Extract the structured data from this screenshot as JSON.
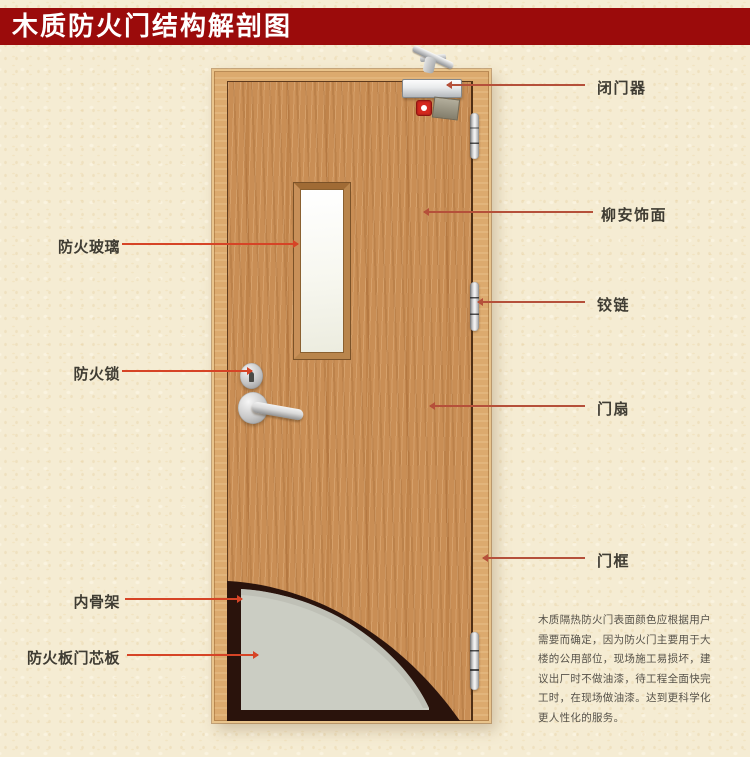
{
  "title": "木质防火门结构解剖图",
  "colors": {
    "banner_bg": "#9b0b0b",
    "banner_text": "#ffffff",
    "background": "#f5ecd3",
    "leader_left": "#d64426",
    "leader_right": "#b5503a",
    "label_text": "#3f3c33",
    "frame_wood": "#dcaa6e",
    "leaf_wood": "#c98e55",
    "skeleton_band": "#2a130c",
    "core_panel": "#cbcdc3",
    "fire_badge": "#d5281e"
  },
  "labels": {
    "left": [
      {
        "id": "fire-glass",
        "text": "防火玻璃"
      },
      {
        "id": "fire-lock",
        "text": "防火锁"
      },
      {
        "id": "inner-skeleton",
        "text": "内骨架"
      },
      {
        "id": "core-board",
        "text": "防火板门芯板"
      }
    ],
    "right": [
      {
        "id": "door-closer",
        "text": "闭门器"
      },
      {
        "id": "veneer",
        "text": "柳安饰面"
      },
      {
        "id": "hinge",
        "text": "铰链"
      },
      {
        "id": "door-leaf",
        "text": "门扇"
      },
      {
        "id": "door-frame",
        "text": "门框"
      }
    ]
  },
  "description": {
    "text": "木质隔热防火门表面颜色应根据用户\n需要而确定，因为防火门主要用于大\n楼的公用部位，现场施工易损坏，建\n议出厂时不做油漆，待工程全面快完\n工时，在现场做油漆。达到更科学化\n更人性化的服务。"
  }
}
